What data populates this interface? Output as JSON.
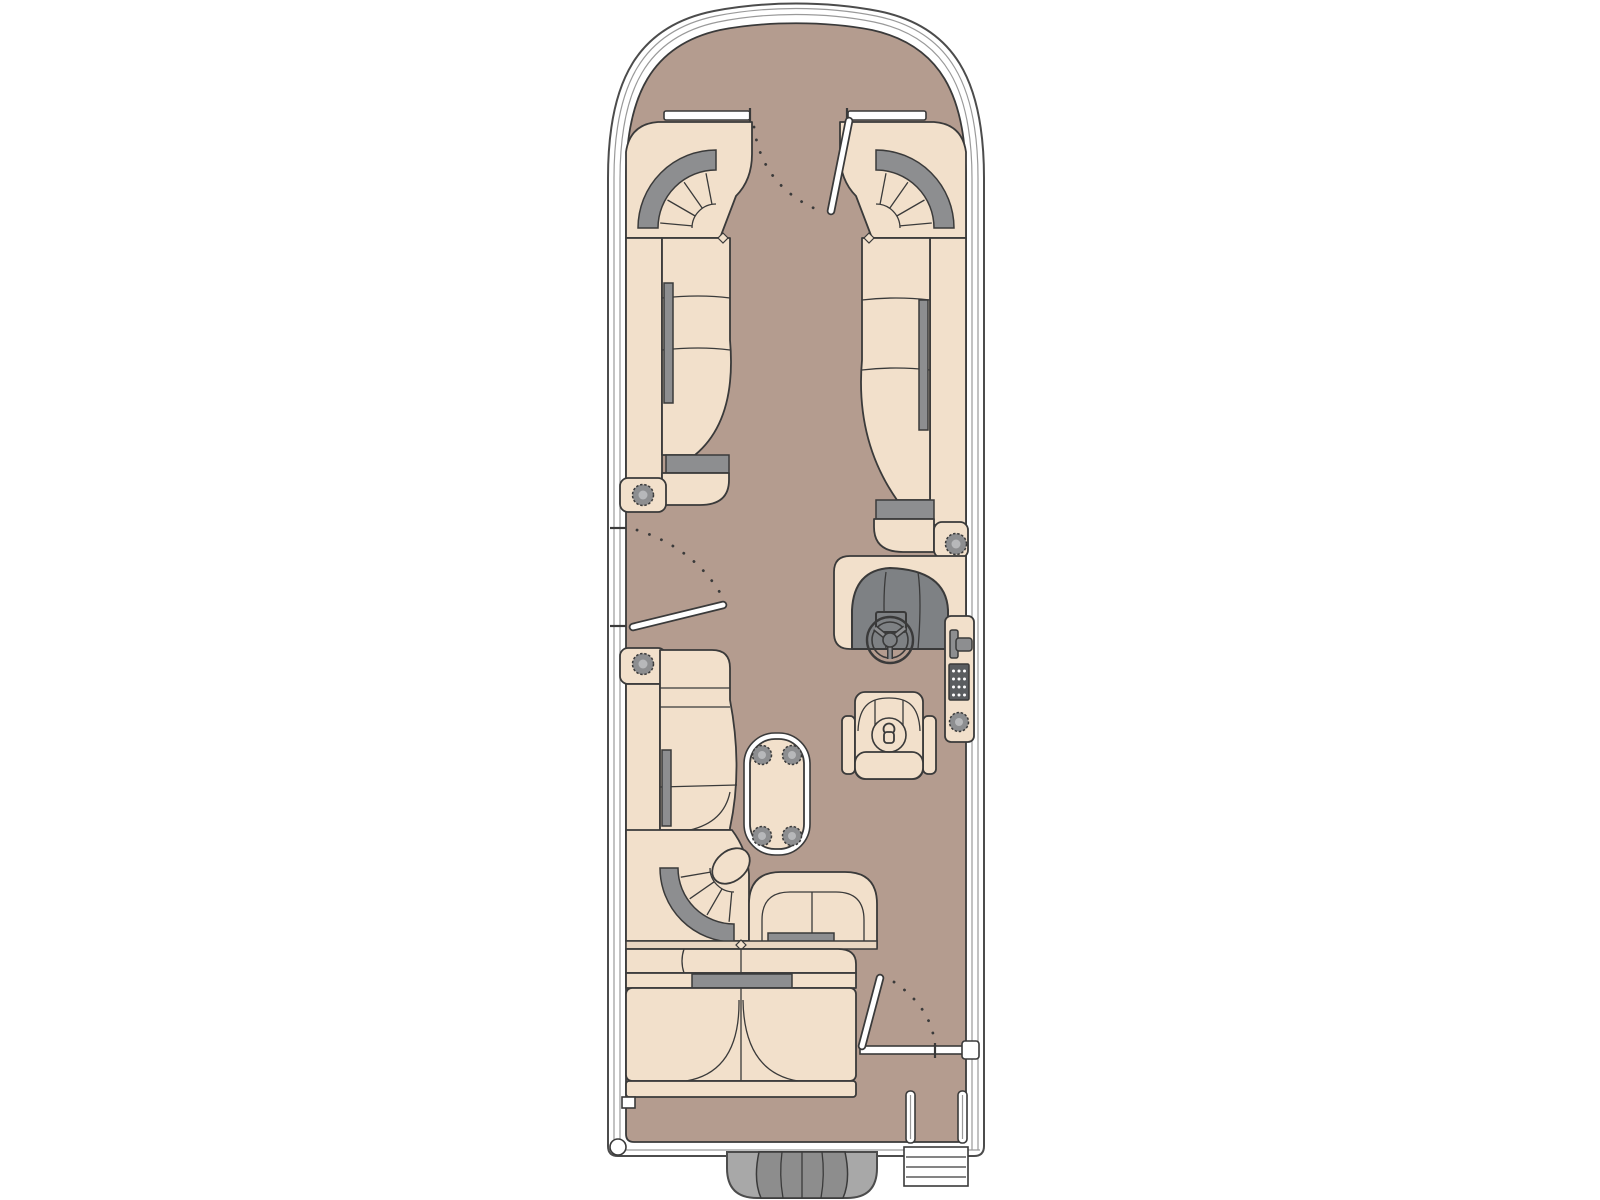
{
  "diagram": {
    "type": "floor-plan",
    "subject": "pontoon boat deck plan, top view, bow at top",
    "components": [
      "hull",
      "bow-deck",
      "bow-gate",
      "port-bow-corner-lounge",
      "starboard-bow-corner-lounge",
      "port-lounge",
      "starboard-lounge",
      "port-boarding-gate",
      "port-aft-chaise-lounge",
      "aft-jump-seat",
      "aft-bench",
      "pedestal-table-with-cupholders",
      "helm-console",
      "steering-wheel",
      "throttle-control",
      "switch-panel",
      "helm-cupholder",
      "captains-chair",
      "stern-gate",
      "boarding-ladder",
      "outboard-motor"
    ],
    "cupholder_count": 8
  },
  "colors": {
    "background": "#ffffff",
    "outline": "#3a3a3a",
    "hull_edge": "#4c4c4c",
    "rail_line": "#9a9a9a",
    "deck": "#b49c8f",
    "seat": "#f2e0cb",
    "band": "#e9d6c1",
    "accent_gray": "#8d8e90",
    "dash_gray": "#7e8184",
    "switch_panel": "#5a5d60",
    "cup_inner": "#b7b8ba",
    "motor_outer": "#a8a8a8",
    "motor_inner": "#8d8d8d"
  }
}
